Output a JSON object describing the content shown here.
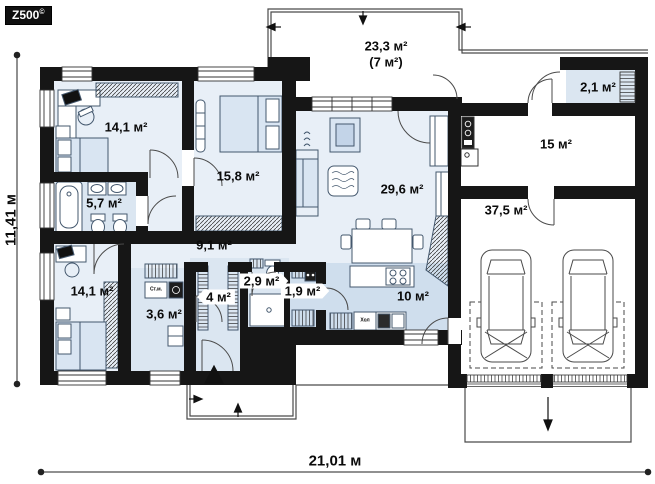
{
  "logo": {
    "text": "Z500",
    "copyright": "©"
  },
  "dimensions": {
    "width": "21,01 м",
    "height": "11,41 м"
  },
  "rooms": {
    "terrace": {
      "label": "23,3 м²",
      "sublabel": "(7 м²)"
    },
    "bedroom1": {
      "label": "14,1 м²"
    },
    "bedroom2": {
      "label": "15,8 м²"
    },
    "bathroom1": {
      "label": "5,7 м²"
    },
    "hallway": {
      "label": "9,1 м²"
    },
    "bedroom3": {
      "label": "14,1 м²"
    },
    "laundry": {
      "label": "3,6 м²"
    },
    "wardrobe": {
      "label": "4 м²"
    },
    "bathroom2": {
      "label": "2,9 м²"
    },
    "pantry": {
      "label": "1,9 м²"
    },
    "living": {
      "label": "29,6 м²"
    },
    "kitchen": {
      "label": "10 м²"
    },
    "utility": {
      "label": "15 м²"
    },
    "garage": {
      "label": "37,5 м²"
    },
    "vestibule": {
      "label": "2,1 м²"
    }
  },
  "appliances": {
    "washer": "Ст.м.",
    "fridge": "Хол"
  },
  "colors": {
    "wall": "#161616",
    "room_light": "#e8eff7",
    "room_medium": "#dbe6f1",
    "kitchen_zone": "#cfdeed",
    "furniture_fill": "#d9e5f2"
  }
}
